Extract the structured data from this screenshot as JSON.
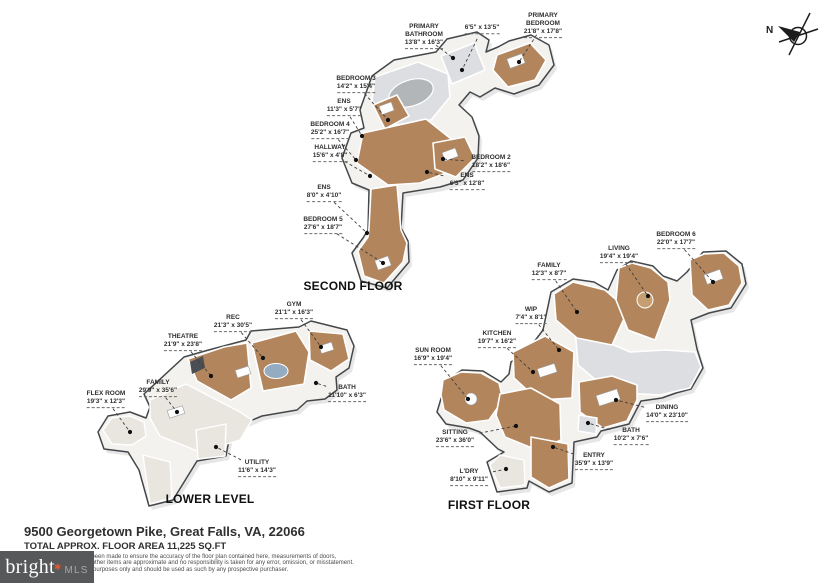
{
  "compass": {
    "label": "N"
  },
  "logo": {
    "brand": "bright",
    "asterisk": "✱",
    "mls": "MLS"
  },
  "footer": {
    "address": "9500 Georgetown Pike, Great Falls, VA, 22066",
    "area": "TOTAL APPROX. FLOOR AREA 11,225 SQ.FT",
    "disclaimer": [
      "Whilst every attempt has been made to ensure the accuracy of the floor plan contained here, measurements of doors,",
      "windows, rooms and any other items are approximate and no responsibility is taken for any error, omission, or misstatement.",
      "This plan is for illustrative purposes only and should be used as such by any prospective purchaser."
    ]
  },
  "colors": {
    "floor_wood": "#b2855c",
    "floor_gray": "#dcdee1",
    "carpet": "#e9e6df",
    "rug_blue": "#94acc1",
    "logo_bg": "#57585a",
    "logo_accent": "#e0562a"
  },
  "floors": [
    {
      "id": "second-floor",
      "title": "SECOND FLOOR",
      "title_x": 353,
      "title_y": 286,
      "rooms": [
        {
          "name": "PRIMARY BATHROOM",
          "dims": "13'8\" x 16'3\"",
          "lx": 424,
          "ly": 36,
          "dx": 453,
          "dy": 58
        },
        {
          "name": "",
          "dims": "6'5\" x 13'5\"",
          "lx": 482,
          "ly": 29,
          "dx": 462,
          "dy": 70
        },
        {
          "name": "PRIMARY BEDROOM",
          "dims": "21'8\" x 17'8\"",
          "lx": 543,
          "ly": 25,
          "dx": 519,
          "dy": 62
        },
        {
          "name": "BEDROOM 3",
          "dims": "14'2\" x 15'4\"",
          "lx": 356,
          "ly": 84,
          "dx": 388,
          "dy": 120
        },
        {
          "name": "ENS",
          "dims": "11'3\" x 5'7\"",
          "lx": 344,
          "ly": 107,
          "dx": 362,
          "dy": 136
        },
        {
          "name": "BEDROOM 4",
          "dims": "25'2\" x 16'7\"",
          "lx": 330,
          "ly": 130,
          "dx": 356,
          "dy": 160
        },
        {
          "name": "HALLWAY",
          "dims": "15'6\" x 4'8\"",
          "lx": 330,
          "ly": 153,
          "dx": 370,
          "dy": 176
        },
        {
          "name": "BEDROOM 2",
          "dims": "18'2\" x 18'6\"",
          "lx": 491,
          "ly": 163,
          "dx": 443,
          "dy": 159
        },
        {
          "name": "ENS",
          "dims": "6'3\" x 12'8\"",
          "lx": 467,
          "ly": 181,
          "dx": 427,
          "dy": 172
        },
        {
          "name": "ENS",
          "dims": "8'0\" x 4'10\"",
          "lx": 324,
          "ly": 193,
          "dx": 367,
          "dy": 233
        },
        {
          "name": "BEDROOM 5",
          "dims": "27'6\" x 18'7\"",
          "lx": 323,
          "ly": 225,
          "dx": 383,
          "dy": 263
        }
      ]
    },
    {
      "id": "lower-level",
      "title": "LOWER LEVEL",
      "title_x": 210,
      "title_y": 499,
      "rooms": [
        {
          "name": "GYM",
          "dims": "21'1\" x 16'3\"",
          "lx": 294,
          "ly": 310,
          "dx": 321,
          "dy": 347
        },
        {
          "name": "REC",
          "dims": "21'3\" x 30'5\"",
          "lx": 233,
          "ly": 323,
          "dx": 263,
          "dy": 358
        },
        {
          "name": "THEATRE",
          "dims": "21'9\" x 23'8\"",
          "lx": 183,
          "ly": 342,
          "dx": 211,
          "dy": 376
        },
        {
          "name": "FAMILY",
          "dims": "29'9\" x 35'6\"",
          "lx": 158,
          "ly": 388,
          "dx": 177,
          "dy": 412
        },
        {
          "name": "FLEX ROOM",
          "dims": "19'3\" x 12'3\"",
          "lx": 106,
          "ly": 399,
          "dx": 130,
          "dy": 432
        },
        {
          "name": "BATH",
          "dims": "11'10\" x 6'3\"",
          "lx": 347,
          "ly": 393,
          "dx": 316,
          "dy": 383
        },
        {
          "name": "UTILITY",
          "dims": "11'6\" x 14'3\"",
          "lx": 257,
          "ly": 468,
          "dx": 216,
          "dy": 447
        }
      ]
    },
    {
      "id": "first-floor",
      "title": "FIRST FLOOR",
      "title_x": 489,
      "title_y": 505,
      "rooms": [
        {
          "name": "BEDROOM 6",
          "dims": "22'0\" x 17'7\"",
          "lx": 676,
          "ly": 240,
          "dx": 713,
          "dy": 282
        },
        {
          "name": "LIVING",
          "dims": "19'4\" x 19'4\"",
          "lx": 619,
          "ly": 254,
          "dx": 648,
          "dy": 296
        },
        {
          "name": "FAMILY",
          "dims": "12'3\" x 8'7\"",
          "lx": 549,
          "ly": 271,
          "dx": 577,
          "dy": 312
        },
        {
          "name": "WIP",
          "dims": "7'4\" x 8'1\"",
          "lx": 531,
          "ly": 315,
          "dx": 559,
          "dy": 350
        },
        {
          "name": "KITCHEN",
          "dims": "19'7\" x 16'2\"",
          "lx": 497,
          "ly": 339,
          "dx": 533,
          "dy": 372
        },
        {
          "name": "SUN ROOM",
          "dims": "16'9\" x 19'4\"",
          "lx": 433,
          "ly": 356,
          "dx": 468,
          "dy": 399
        },
        {
          "name": "SITTING",
          "dims": "23'6\" x 36'0\"",
          "lx": 455,
          "ly": 438,
          "dx": 516,
          "dy": 426
        },
        {
          "name": "L'DRY",
          "dims": "8'10\" x 9'11\"",
          "lx": 469,
          "ly": 477,
          "dx": 506,
          "dy": 469
        },
        {
          "name": "ENTRY",
          "dims": "35'9\" x 13'9\"",
          "lx": 594,
          "ly": 461,
          "dx": 553,
          "dy": 447
        },
        {
          "name": "BATH",
          "dims": "10'2\" x 7'6\"",
          "lx": 631,
          "ly": 436,
          "dx": 588,
          "dy": 423
        },
        {
          "name": "DINING",
          "dims": "14'0\" x 23'10\"",
          "lx": 667,
          "ly": 413,
          "dx": 616,
          "dy": 400
        }
      ]
    }
  ]
}
